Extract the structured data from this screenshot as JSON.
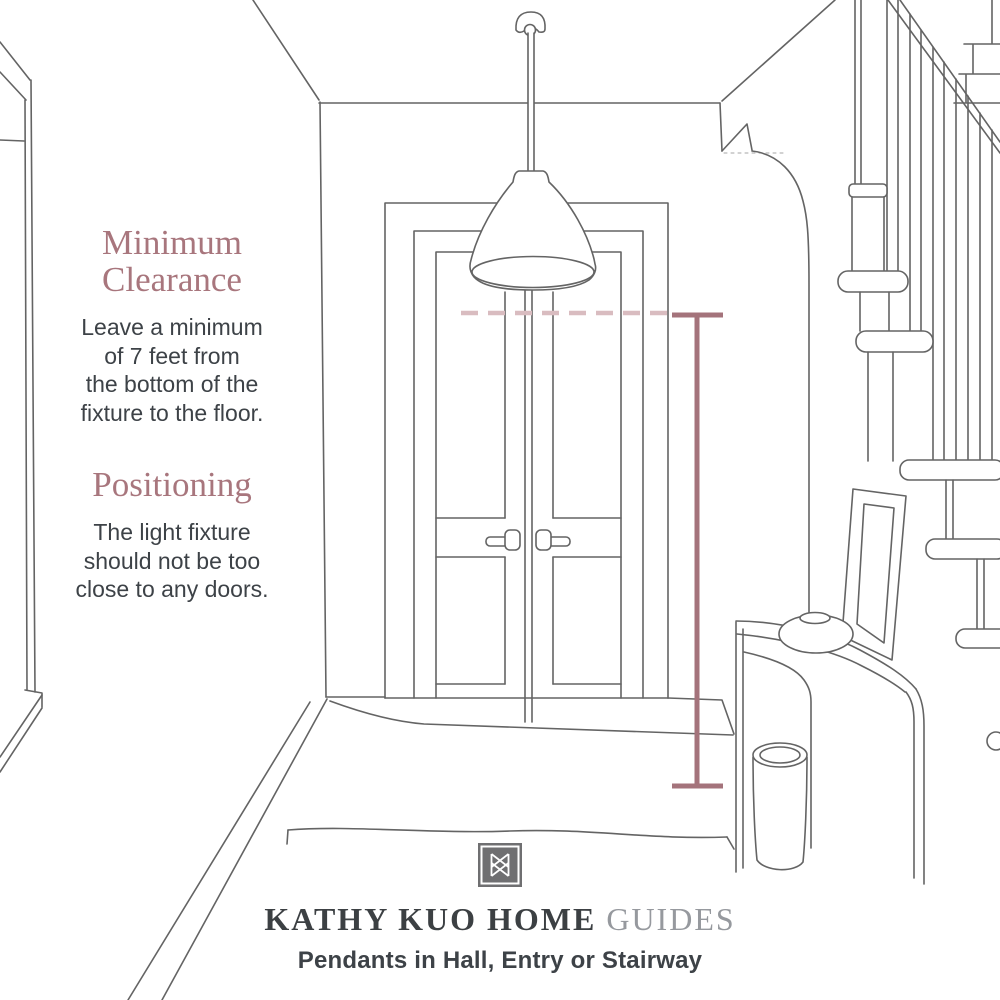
{
  "illustration": {
    "scene": "hallway entry with double doors, pendant light and stairway",
    "elements": [
      "pendant-light",
      "ceiling-canopy",
      "double-doors",
      "door-handles",
      "left-doorway",
      "staircase",
      "handrail",
      "balusters",
      "stair-treads",
      "console-table",
      "decorative-bowl",
      "picture-frame",
      "basket",
      "rug",
      "clearance-dashed-line",
      "measurement-line"
    ]
  },
  "annotations": {
    "clearance": {
      "heading_lines": [
        "Minimum",
        "Clearance"
      ],
      "body_lines": [
        "Leave a minimum",
        "of 7 feet from",
        "the bottom of the",
        "fixture to the floor."
      ]
    },
    "positioning": {
      "heading": "Positioning",
      "body_lines": [
        "The light fixture",
        "should not be too",
        "close to any doors."
      ]
    }
  },
  "footer": {
    "logo": "kathy-kuo-home-monogram",
    "brand": "KATHY KUO HOME",
    "brand_suffix": "GUIDES",
    "subtitle": "Pendants in Hall, Entry or Stairway"
  },
  "colors": {
    "accent_heading": "#a8767d",
    "measurement_line": "#a4737b",
    "clearance_dashed_line": "#d9bcc0",
    "sketch_line": "#646464",
    "text": "#3d4247",
    "brand_text": "#3c4043",
    "brand_suffix_text": "#96999e",
    "logo_background": "#6f6f71"
  }
}
